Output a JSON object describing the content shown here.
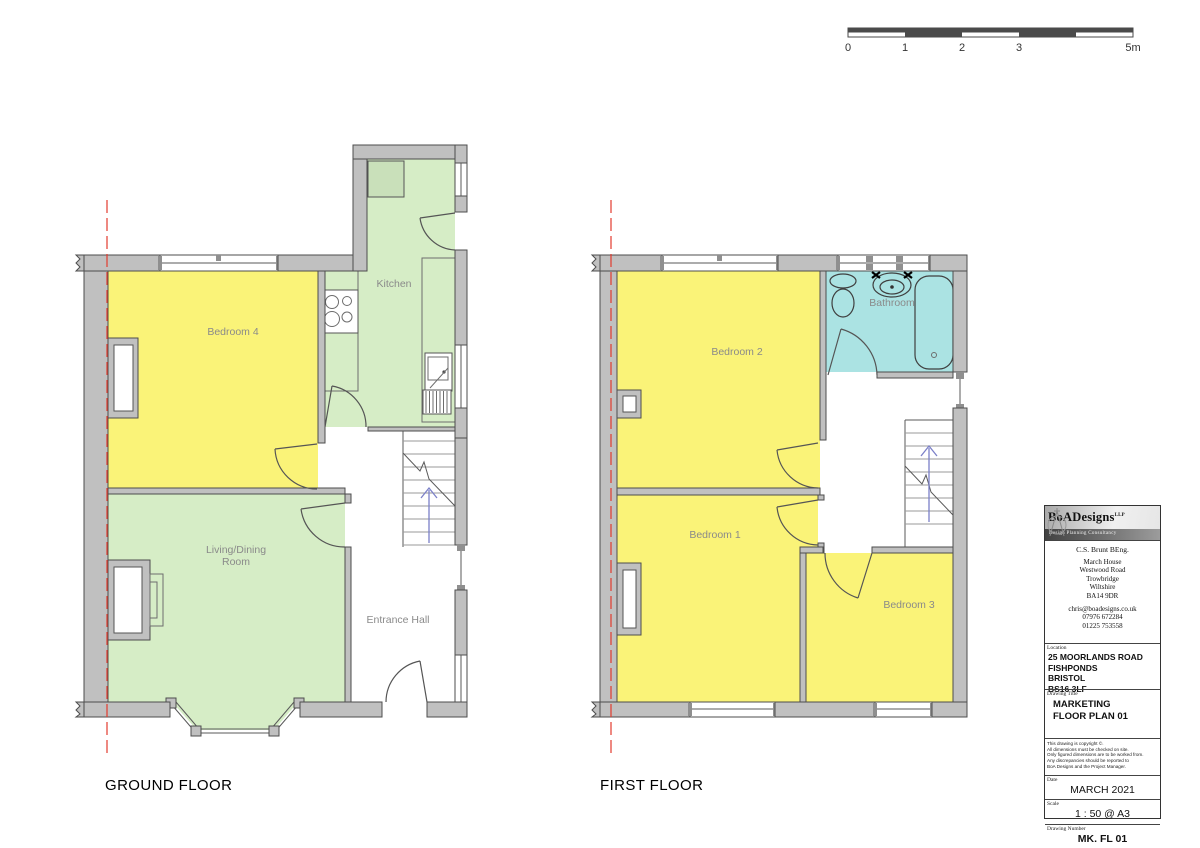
{
  "scale_bar": {
    "tick_labels": [
      "0",
      "1",
      "2",
      "3",
      "5m"
    ]
  },
  "floors": {
    "ground": {
      "title": "GROUND FLOOR",
      "rooms": {
        "bedroom4": "Bedroom 4",
        "kitchen": "Kitchen",
        "living": "Living/Dining\nRoom",
        "entrance": "Entrance Hall"
      }
    },
    "first": {
      "title": "FIRST FLOOR",
      "rooms": {
        "bedroom2": "Bedroom 2",
        "bathroom": "Bathroom",
        "bedroom1": "Bedroom 1",
        "bedroom3": "Bedroom 3"
      }
    }
  },
  "title_block": {
    "company": "BoADesigns",
    "company_suffix": "LLP",
    "tagline": "Design Planning Consultancy",
    "principal": "C.S. Brunt  BEng.",
    "address": "March House\nWestwood Road\nTrowbridge\nWiltshire\nBA14 9DR",
    "contact": "chris@boadesigns.co.uk\n07976 672284\n01225 753558",
    "location_label": "Location",
    "location": "25 MOORLANDS ROAD\nFISHPONDS\nBRISTOL\nBS16 3LF",
    "drawing_title_label": "Drawing Title",
    "drawing_title": "MARKETING\nFLOOR  PLAN 01",
    "notes": "This drawing is copyright ©.\nAll dimensions must be checked on site.\nOnly figured dimensions are to be worked from.\nAny discrepancies should be reported to\nBoA Designs and the Project Manager.",
    "date_label": "Date",
    "date": "MARCH 2021",
    "scale_label": "Scale",
    "scale": "1 : 50 @ A3",
    "drawing_number_label": "Drawing Number",
    "drawing_number": "MK. FL 01"
  },
  "colors": {
    "room_yellow": "#FAF378",
    "room_green": "#D6EDC6",
    "room_cyan": "#ABE3E3",
    "wall_gray": "#C0C0C0",
    "boundary_red": "#E23B2E",
    "stair_arrow_blue": "#7B80C8"
  }
}
